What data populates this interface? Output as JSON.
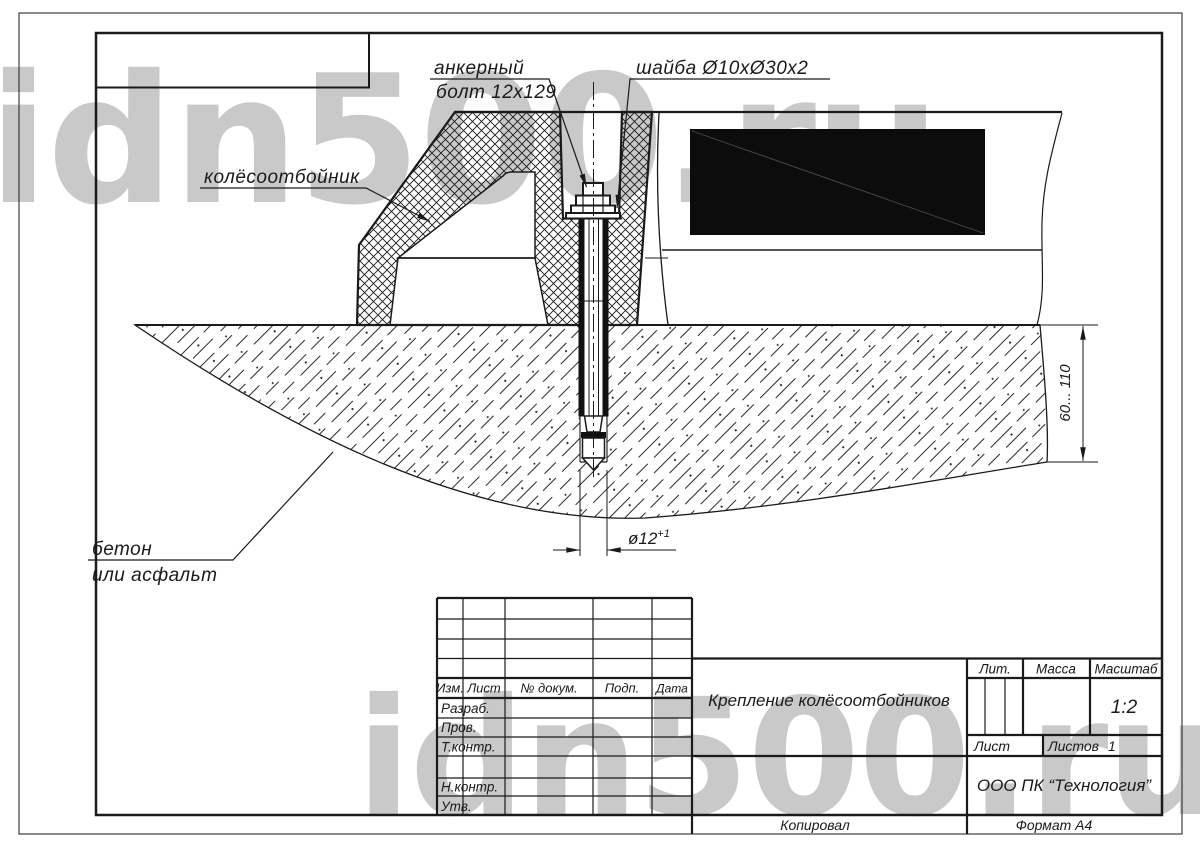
{
  "watermark": {
    "text": "idn500.ru"
  },
  "callouts": {
    "anchor_bolt_line1": "анкерный",
    "anchor_bolt_line2": "болт 12х129",
    "washer": "шайба Ø10хØ30х2",
    "wheel_stop": "колёсоотбойник",
    "base_line1": "бетон",
    "base_line2": "или асфальт"
  },
  "dimensions": {
    "embed_depth": "60... 110",
    "hole_diameter": "ø12",
    "hole_tolerance": "+1"
  },
  "title_block": {
    "header_cols": [
      "Изм.",
      "Лист",
      "№ докум.",
      "Подп.",
      "Дата"
    ],
    "row_labels": {
      "developed": "Разраб.",
      "checked": "Пров.",
      "tcontrol": "Т.контр.",
      "ncontrol": "Н.контр.",
      "approved": "Утв."
    },
    "doc_title": "Крепление колёсоотбойников",
    "lit_label": "Лит.",
    "mass_label": "Масса",
    "scale_label": "Масштаб",
    "scale_value": "1:2",
    "sheet_label": "Лист",
    "sheets_label": "Листов",
    "sheets_value": "1",
    "company": "ООО ПК “Технология”",
    "footer_copy": "Копировал",
    "footer_format": "Формат  А4"
  }
}
